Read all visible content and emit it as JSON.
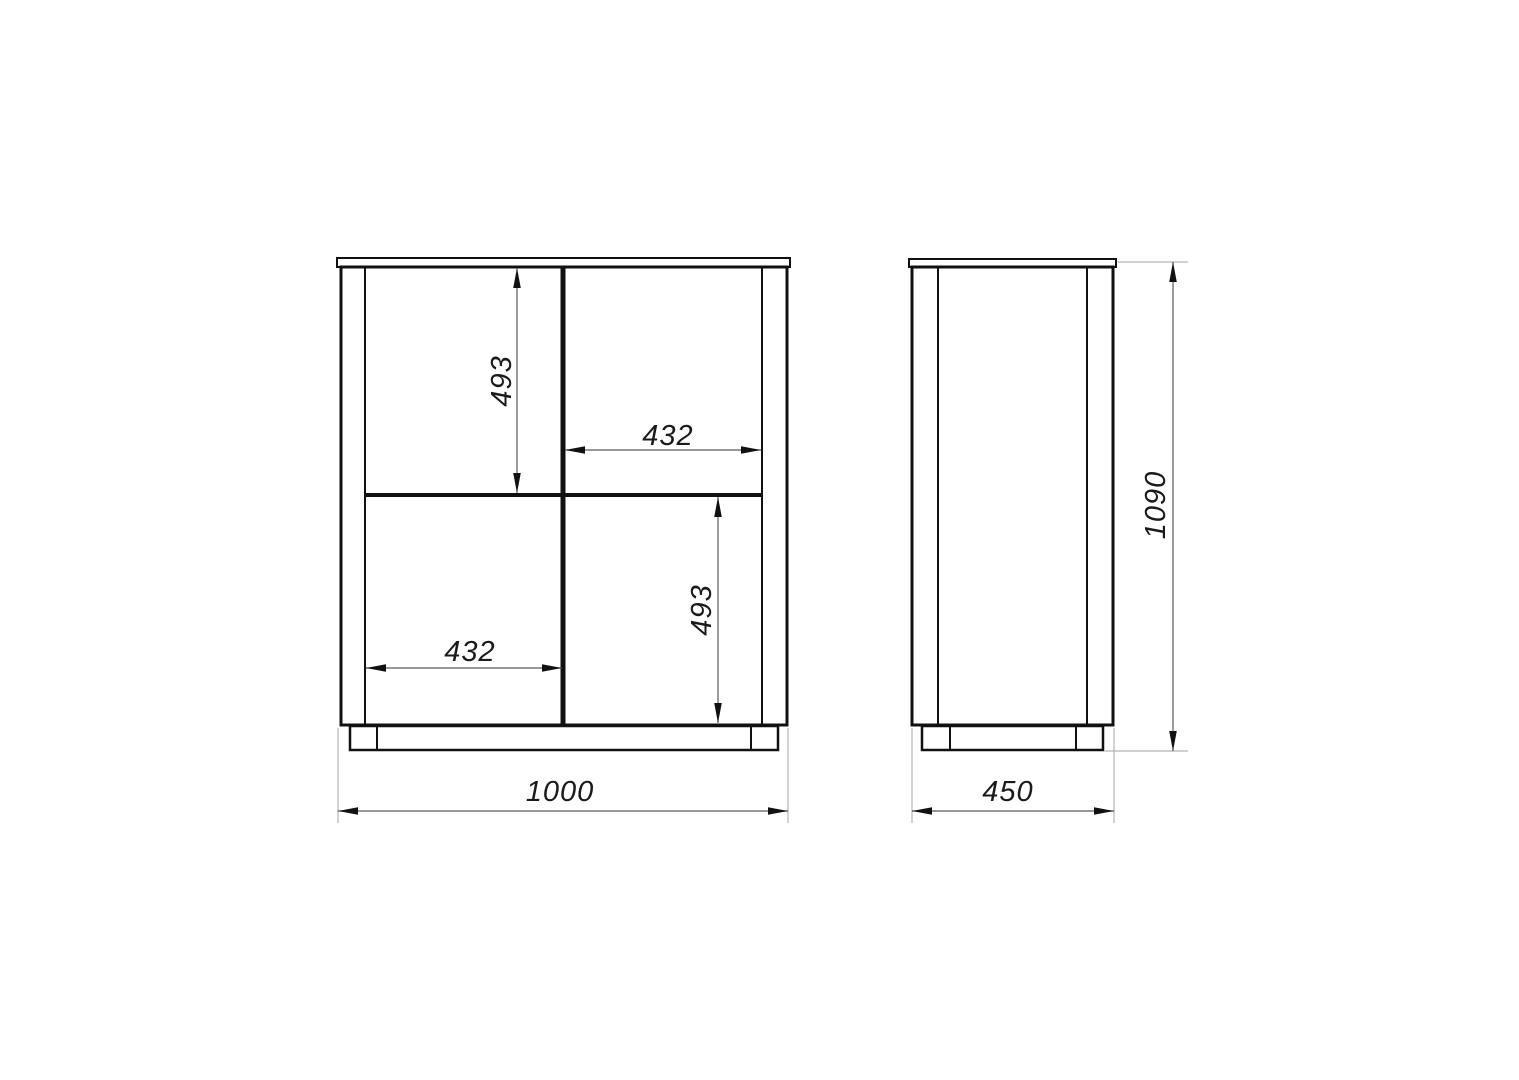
{
  "drawing": {
    "dimensions": {
      "front": {
        "overall_width": "1000",
        "upper_left_height": "493",
        "upper_right_width": "432",
        "lower_left_width": "432",
        "lower_right_height": "493"
      },
      "side": {
        "depth": "450",
        "overall_height": "1090"
      }
    },
    "colors": {
      "part_line": "#111111",
      "dimension_line": "#5a5a5a",
      "extension_line": "#b3b3b3",
      "label_text": "#1a1a1a",
      "background": "#ffffff"
    }
  }
}
